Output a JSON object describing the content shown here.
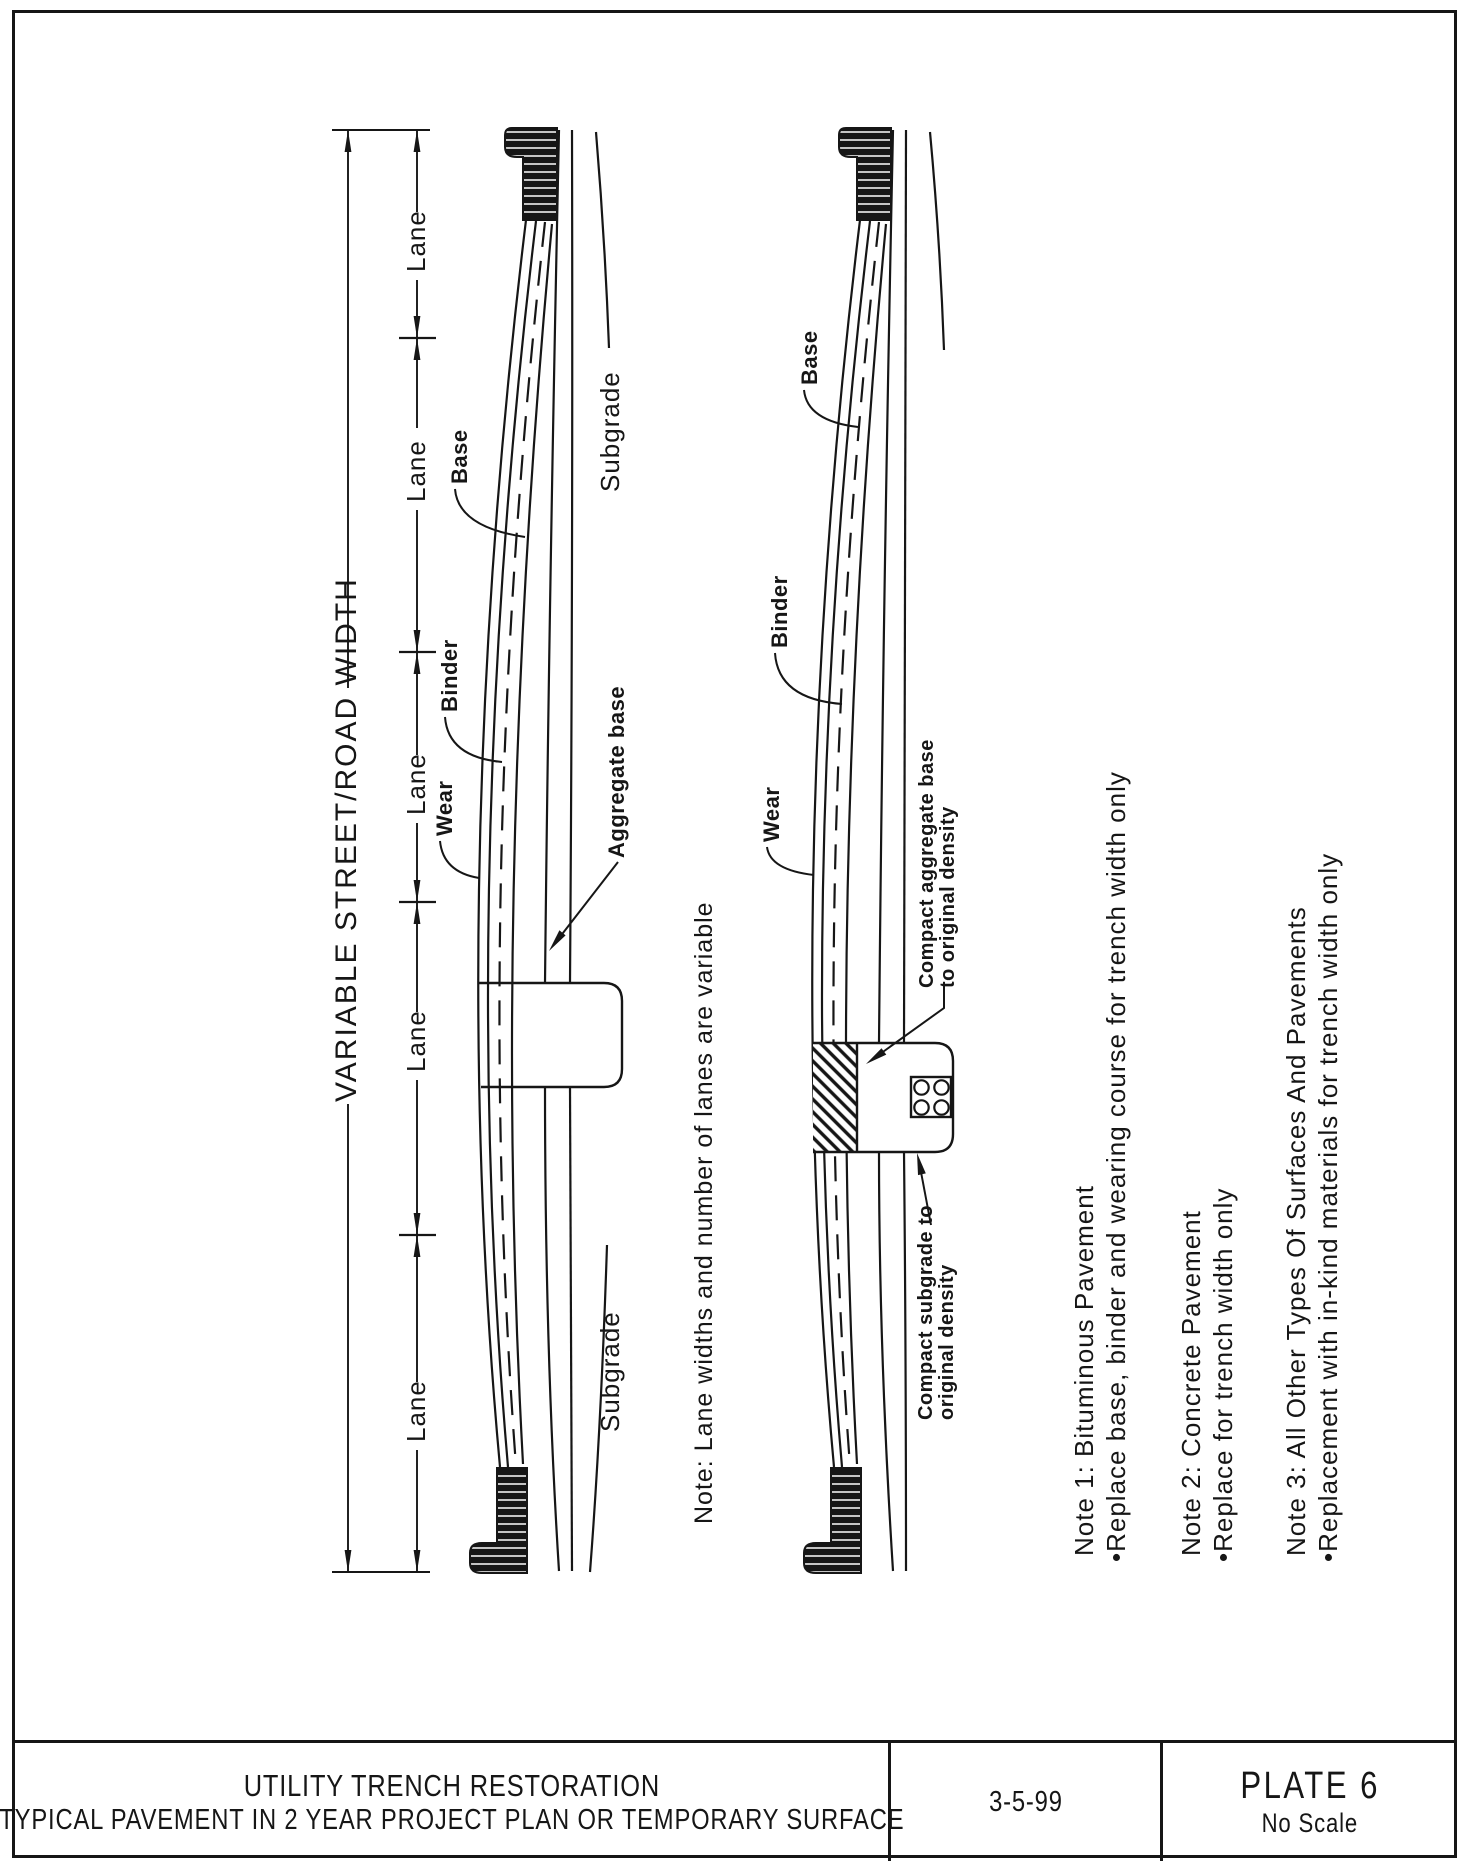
{
  "title_block": {
    "project_title": "UTILITY TRENCH RESTORATION",
    "sheet_subtitle": "TYPICAL PAVEMENT IN 2 YEAR PROJECT PLAN OR TEMPORARY SURFACE",
    "date": "3-5-99",
    "plate_label": "PLATE 6",
    "scale_label": "No Scale"
  },
  "dimensions": {
    "overall_width_label": "VARIABLE STREET/ROAD WIDTH",
    "lane_labels": [
      "Lane",
      "Lane",
      "Lane",
      "Lane",
      "Lane"
    ]
  },
  "section_full_restoration": {
    "subgrade_label_upper": "Subgrade",
    "subgrade_label_lower": "Subgrade",
    "wear_label": "Wear",
    "binder_label": "Binder",
    "base_label": "Base",
    "aggregate_base_label": "Aggregate base"
  },
  "section_trench_detail": {
    "base_label": "Base",
    "binder_label": "Binder",
    "wear_label": "Wear",
    "compact_aggregate_label_line1": "Compact aggregate base",
    "compact_aggregate_label_line2": "to original density",
    "compact_subgrade_label_line1": "Compact subgrade to",
    "compact_subgrade_label_line2": "original density"
  },
  "center_note": "Note: Lane widths and number of lanes are variable",
  "notes": [
    {
      "heading": "Note 1: Bituminous Pavement",
      "bullet": "•Replace base, binder and wearing course for trench width only"
    },
    {
      "heading": "Note 2: Concrete Pavement",
      "bullet": "•Replace for trench width only"
    },
    {
      "heading": "Note 3: All Other Types Of Surfaces And Pavements",
      "bullet": "•Replacement with in-kind materials for trench width only"
    }
  ],
  "colors": {
    "ink": "#161616",
    "paper": "#ffffff"
  }
}
